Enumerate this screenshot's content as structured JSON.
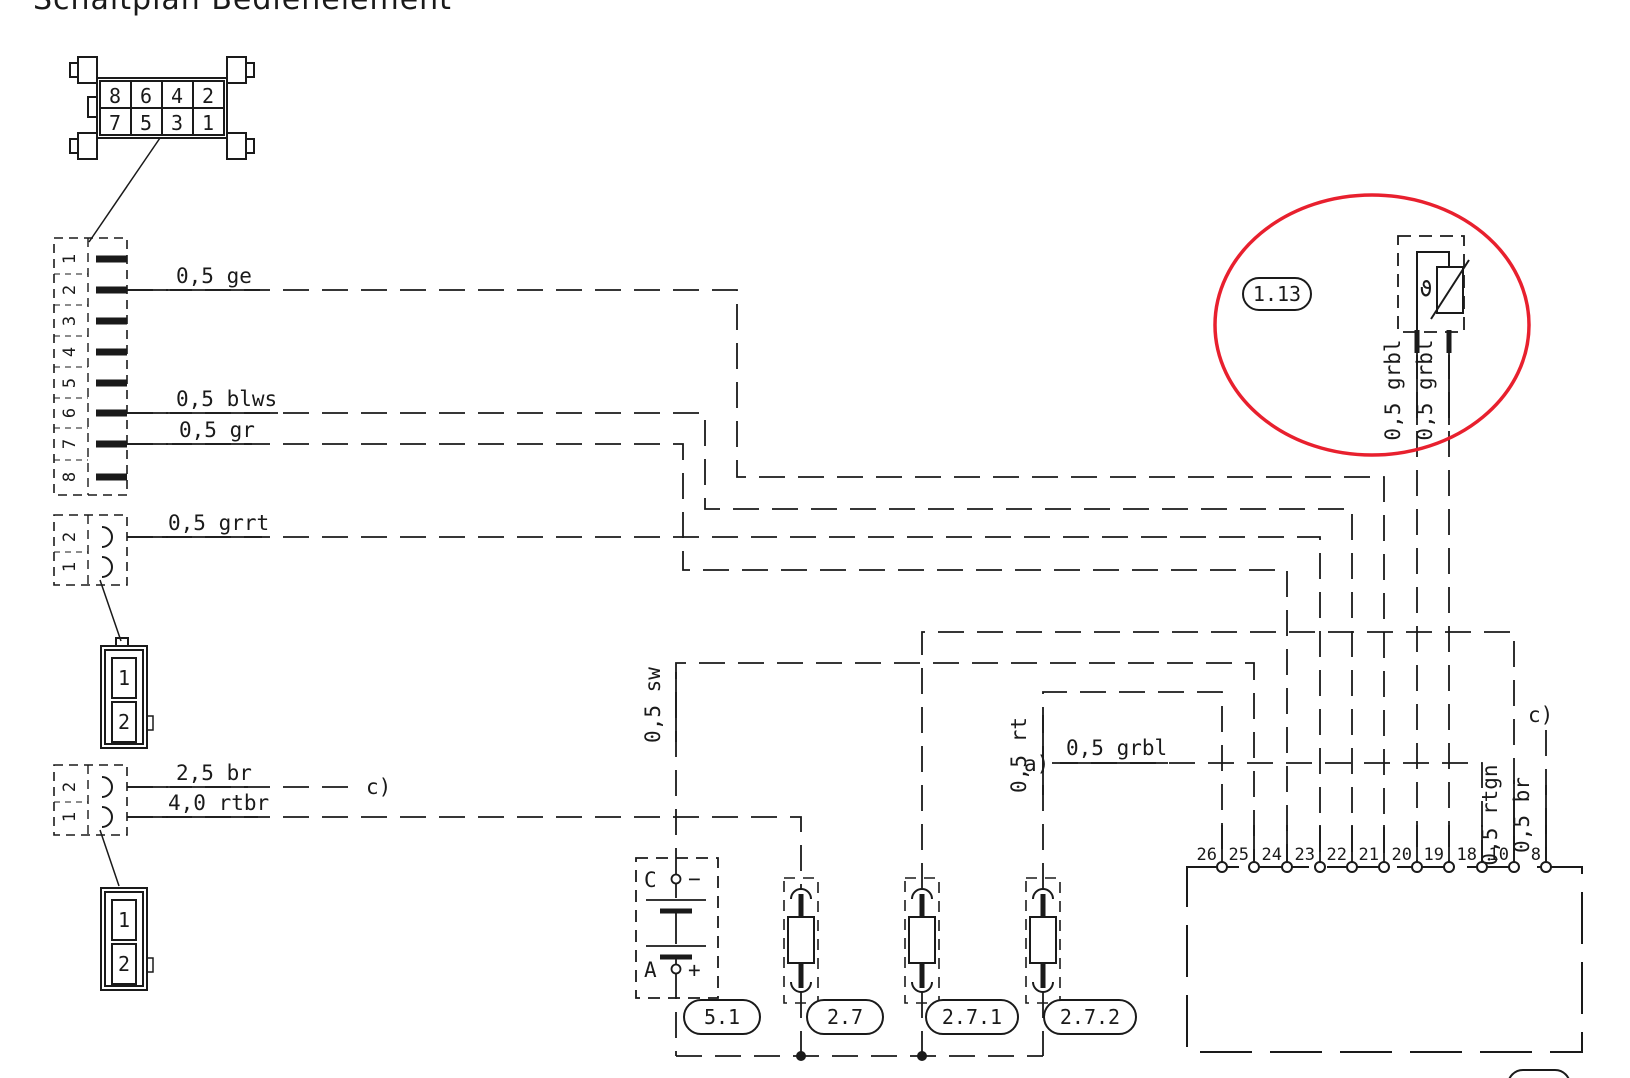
{
  "title": "Schaltplan  Bedienelement",
  "colors": {
    "line": "#1a1a1a",
    "highlight": "#e8202e"
  },
  "plug_top": {
    "cells": [
      "8",
      "6",
      "4",
      "2",
      "7",
      "5",
      "3",
      "1"
    ]
  },
  "conn_a": {
    "pins": [
      "1",
      "2",
      "3",
      "4",
      "5",
      "6",
      "7",
      "8"
    ]
  },
  "conn_b": {
    "pins": [
      "2",
      "1"
    ]
  },
  "conn_c": {
    "pins": [
      "2",
      "1"
    ]
  },
  "plug_b": {
    "cells": [
      "1",
      "2"
    ]
  },
  "plug_c": {
    "cells": [
      "1",
      "2"
    ]
  },
  "wires": {
    "ge": "0,5 ge",
    "blws": "0,5 blws",
    "gr": "0,5 gr",
    "grrt": "0,5 grrt",
    "br25": "2,5 br",
    "rtbr": "4,0 rtbr",
    "sw": "0,5 sw",
    "rt": "0,5 rt",
    "grbl_a": "0,5 grbl",
    "grbl_s1": "0,5 grbl",
    "grbl_s2": "0,5 grbl",
    "rtgn": "0,5 rtgn",
    "br05": "0,5 br"
  },
  "refs": {
    "a": "a)",
    "c_left": "c)",
    "c_right": "c)"
  },
  "components": {
    "sensor": {
      "id": "1.13",
      "symbol": "ϑ"
    },
    "battery": {
      "id": "5.1",
      "top_label": "C",
      "top_sign": "−",
      "bottom_label": "A",
      "bottom_sign": "+"
    },
    "lamp1": {
      "id": "2.7"
    },
    "lamp2": {
      "id": "2.7.1"
    },
    "lamp3": {
      "id": "2.7.2"
    }
  },
  "ecu": {
    "pins": [
      "26",
      "25",
      "24",
      "23",
      "22",
      "21",
      "20",
      "19",
      "18",
      "10",
      "8"
    ]
  }
}
